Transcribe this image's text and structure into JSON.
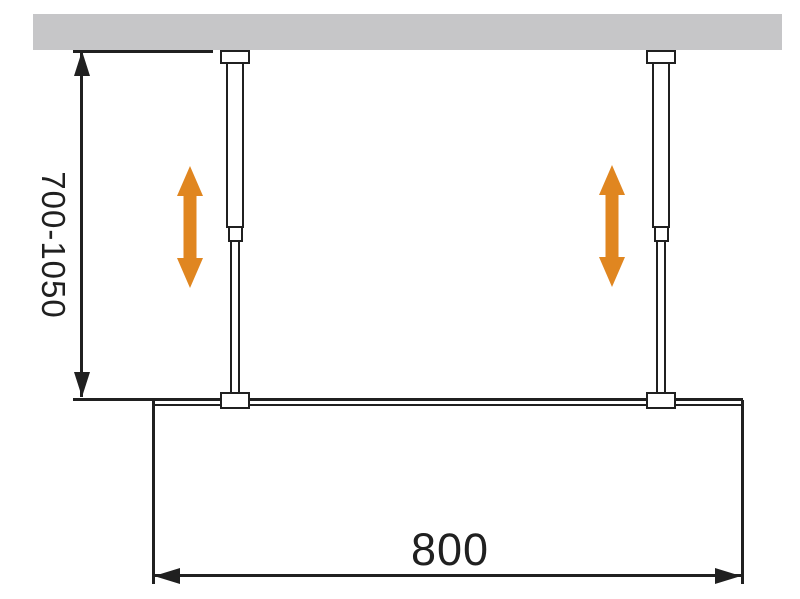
{
  "diagram": {
    "height_range_label": "700-1050",
    "width_label": "800",
    "colors": {
      "background": "#FFFFFF",
      "ceiling": "#C6C6C8",
      "line": "#202020",
      "adjust_arrow": "#E08620"
    },
    "icons": {
      "left_adjust": "vertical-double-arrow-icon",
      "right_adjust": "vertical-double-arrow-icon"
    }
  }
}
